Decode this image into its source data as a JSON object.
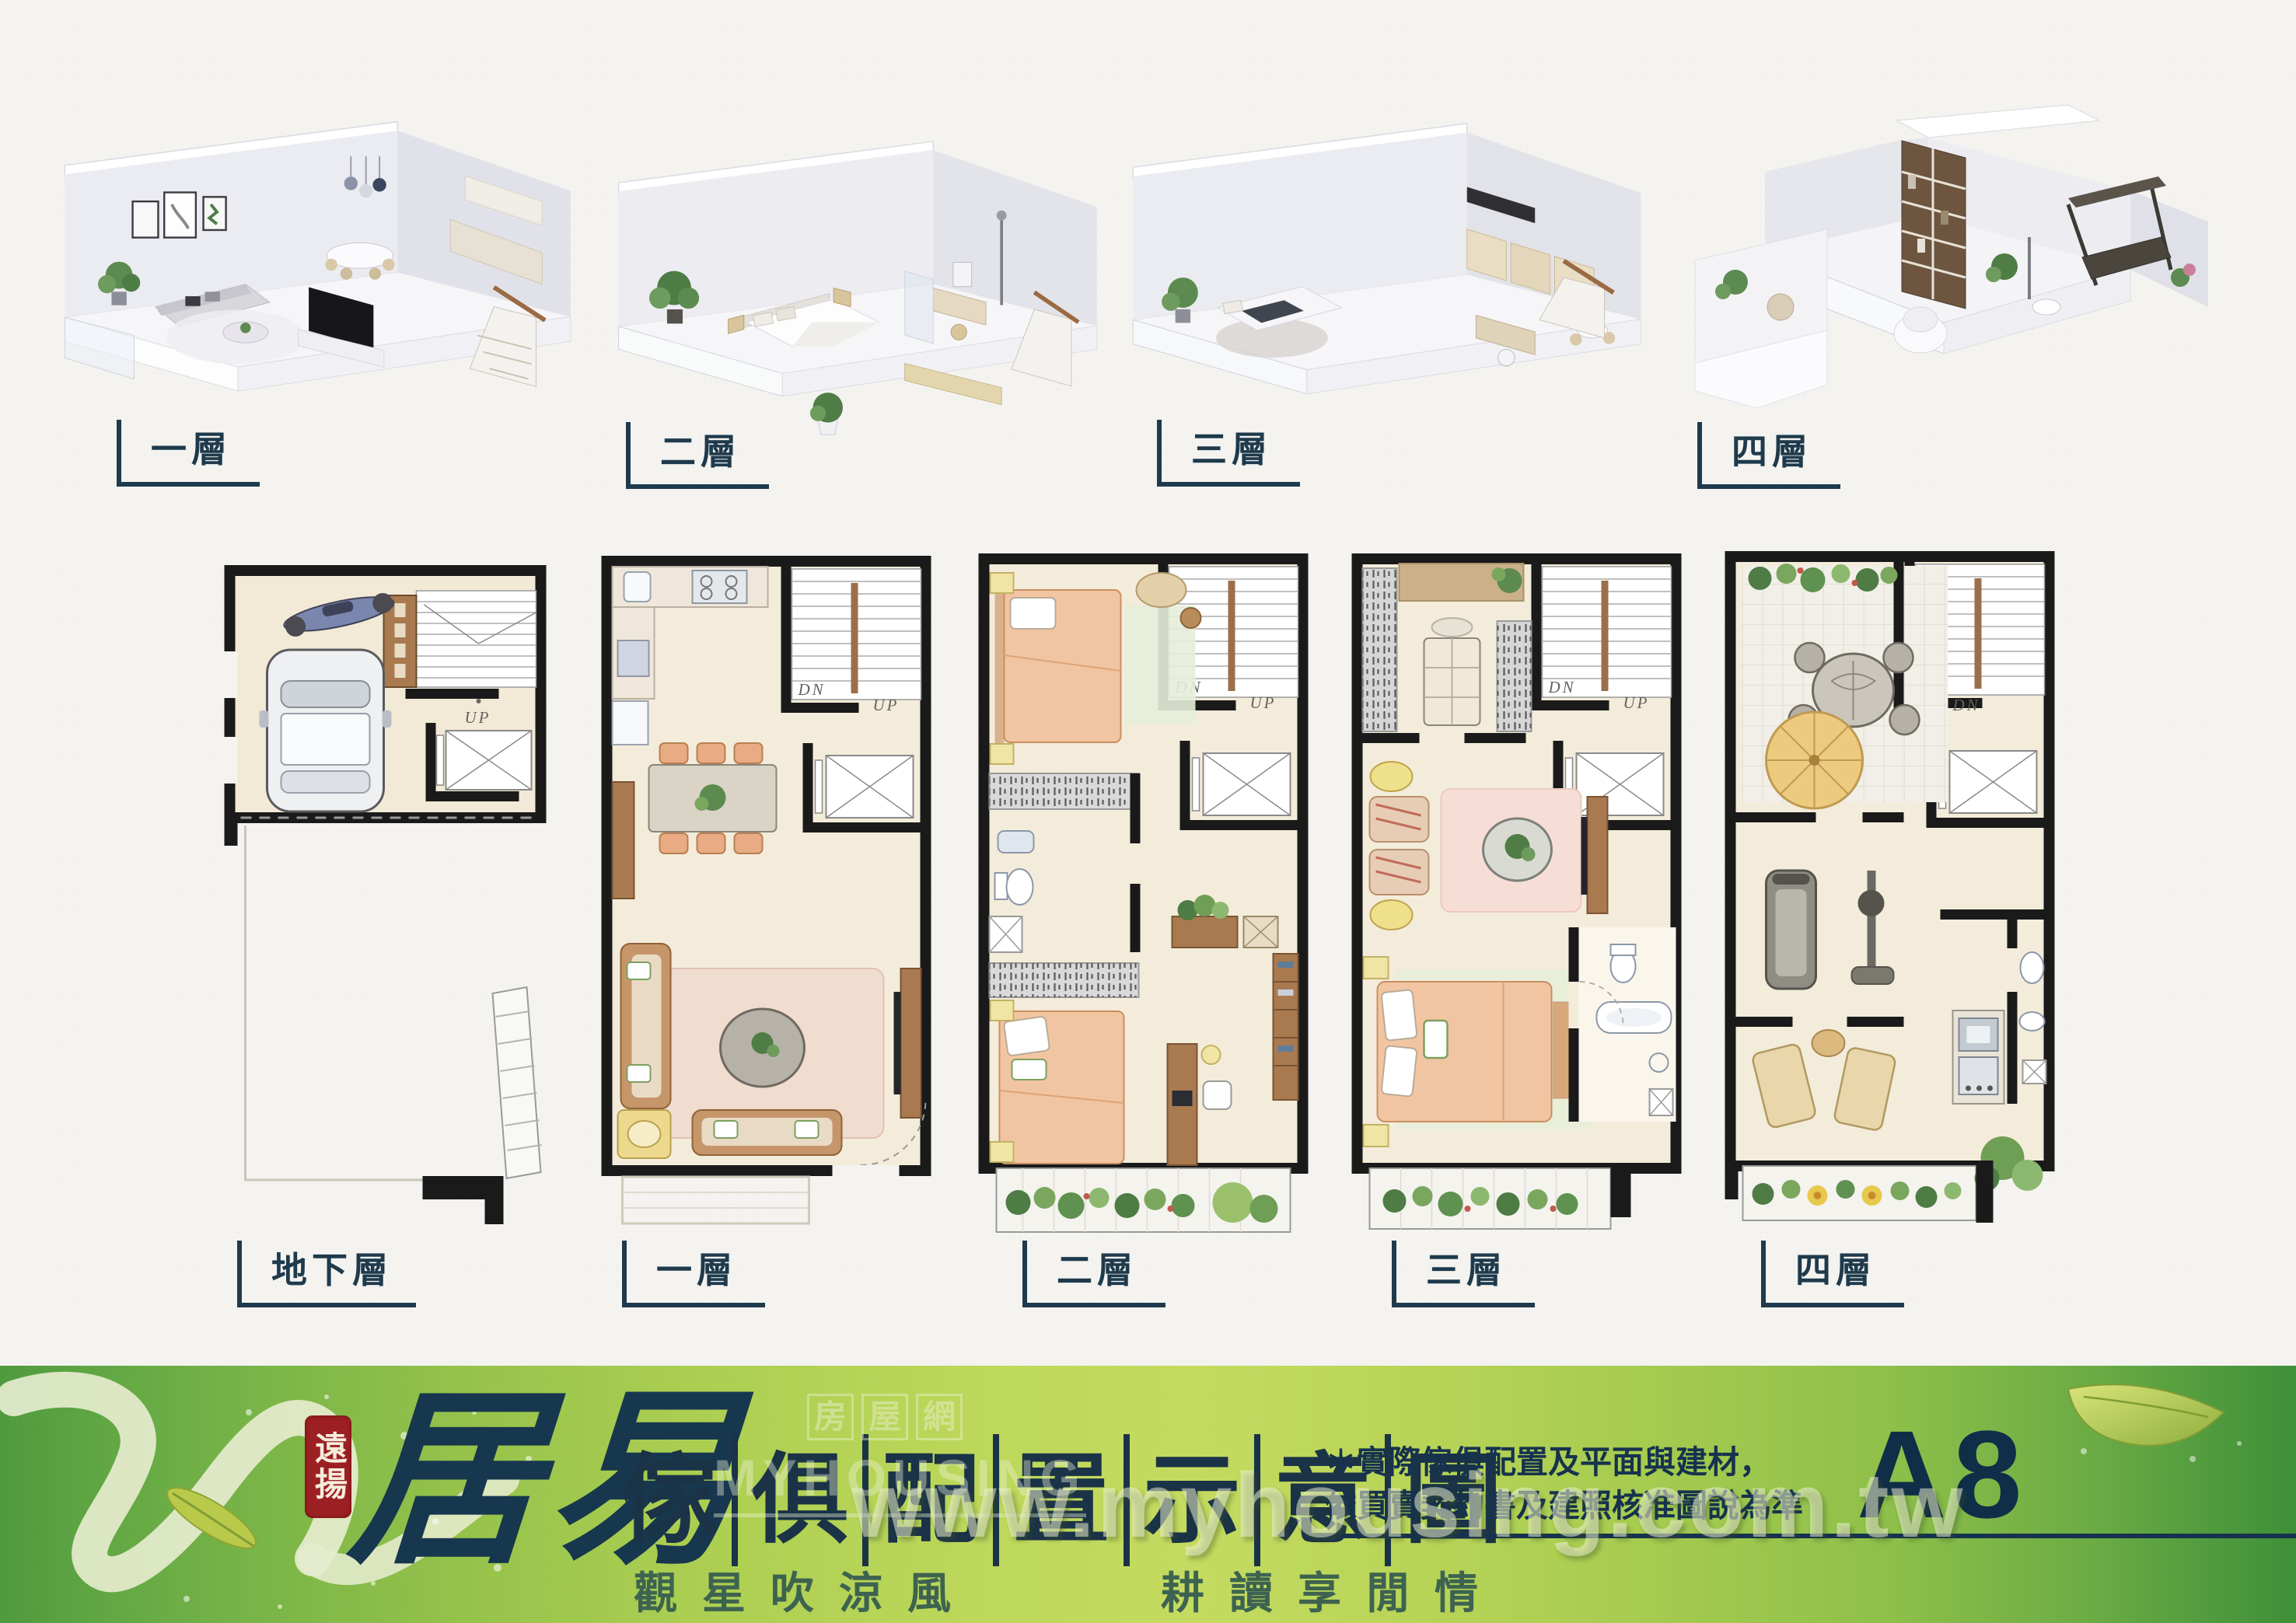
{
  "colors": {
    "accent_navy": "#1e3a4c",
    "seal_red": "#9c2023",
    "banner_green": "#8fbf4a",
    "plan_beige": "#f4ecda"
  },
  "renders_3d": [
    {
      "label": "一層"
    },
    {
      "label": "二層"
    },
    {
      "label": "三層"
    },
    {
      "label": "四層"
    }
  ],
  "floor_plans": [
    {
      "label": "地下層",
      "up": "UP"
    },
    {
      "label": "一層",
      "dn": "DN",
      "up": "UP"
    },
    {
      "label": "二層",
      "dn": "DN",
      "up": "UP"
    },
    {
      "label": "三層",
      "dn": "DN",
      "up": "UP"
    },
    {
      "label": "四層",
      "dn": "DN"
    }
  ],
  "banner": {
    "seal": "遠揚",
    "brand": "居易",
    "title_chars": [
      "傢",
      "俱",
      "配",
      "置",
      "示",
      "意",
      "圖"
    ],
    "slogan_left": "觀星吹涼風",
    "slogan_right": "耕讀享閒情",
    "disclaimer_line1": "＊實際傢俱配置及平面與建材，",
    "disclaimer_line2": "依買賣契約書及建照核准圖說為準",
    "unit_label": "A8",
    "watermark_url": "www.myhousing.com.tw",
    "watermark_brand": "MYHOUSING",
    "watermark_box1": "房",
    "watermark_box2": "屋",
    "watermark_box3": "網"
  }
}
